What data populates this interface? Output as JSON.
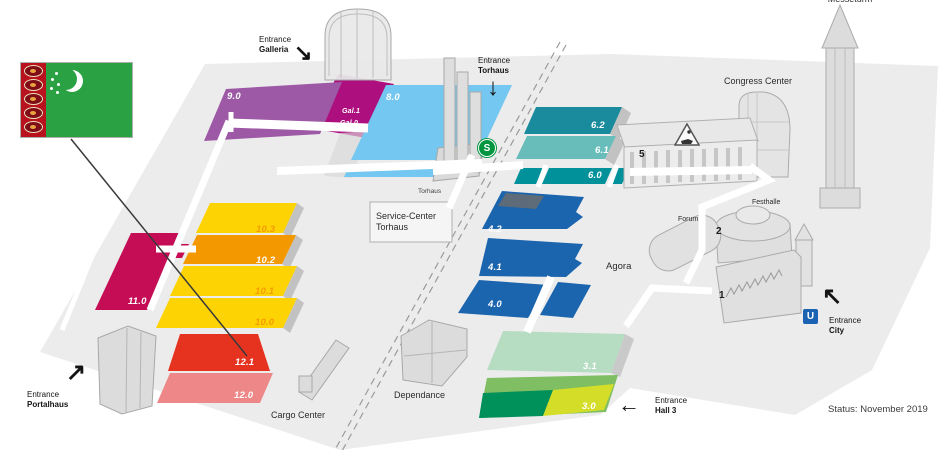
{
  "map": {
    "status": "Status: November 2019",
    "flag": {
      "country": "Turkmenistan",
      "field_color": "#2aa143",
      "stripe_color": "#b9121f"
    },
    "badges": {
      "sbahn": {
        "label": "S",
        "color": "#00963f"
      },
      "ubahn": {
        "label": "U",
        "color": "#1b63b2"
      }
    },
    "entrances": {
      "galleria": {
        "line1": "Entrance",
        "line2": "Galleria",
        "arrow": "↘"
      },
      "torhaus": {
        "line1": "Entrance",
        "line2": "Torhaus",
        "arrow": "↓"
      },
      "hall3": {
        "line1": "Entrance",
        "line2": "Hall 3",
        "arrow": "←"
      },
      "city": {
        "line1": "Entrance",
        "line2": "City",
        "arrow": "↖"
      },
      "portalhaus": {
        "line1": "Entrance",
        "line2": "Portalhaus",
        "arrow": "↗"
      }
    },
    "buildings": {
      "messeturm": "Messeturm",
      "congress_center": "Congress Center",
      "festhalle": "Festhalle",
      "forum": "Forum",
      "service_center_line1": "Service-Center",
      "service_center_line2": "Torhaus",
      "torhaus": "Torhaus",
      "agora": "Agora",
      "dependance": "Dependance",
      "cargo_center": "Cargo Center"
    },
    "halls": {
      "h9_0": {
        "label": "9.0",
        "color": "#9d59a5",
        "label_color": "#ffffff"
      },
      "gal": {
        "upper_label": "Gal.1",
        "lower_label": "Gal.0",
        "color": "#ae0f7f",
        "label_color": "#ffffff"
      },
      "h8_0": {
        "label": "8.0",
        "color": "#74c7f0",
        "label_color": "#ffffff"
      },
      "h6_2": {
        "label": "6.2",
        "color": "#1a8b9c",
        "label_color": "#ffffff"
      },
      "h6_1": {
        "label": "6.1",
        "color": "#68bdbb",
        "label_color": "#ffffff"
      },
      "h6_0": {
        "label": "6.0",
        "color": "#00919b",
        "label_color": "#ffffff"
      },
      "h5": {
        "label": "5",
        "color": "#ececec",
        "label_color": "#1a1a1a"
      },
      "h4_2": {
        "label": "4.2",
        "color": "#1b64ae",
        "roof_color": "#5e6b78",
        "label_color": "#ffffff"
      },
      "h4_1": {
        "label": "4.1",
        "color": "#1b64ae",
        "label_color": "#ffffff"
      },
      "h4_0": {
        "label": "4.0",
        "color": "#1b64ae",
        "label_color": "#ffffff"
      },
      "h10_3": {
        "label": "10.3",
        "color": "#fdd303",
        "label_color": "#f59c00"
      },
      "h10_2": {
        "label": "10.2",
        "color": "#f49800",
        "label_color": "#ffffff"
      },
      "h10_1": {
        "label": "10.1",
        "color": "#fdd303",
        "label_color": "#f59c00"
      },
      "h10_0": {
        "label": "10.0",
        "color": "#fdd303",
        "label_color": "#f59c00"
      },
      "h11_0": {
        "label": "11.0",
        "color": "#c40d55",
        "label_color": "#ffffff"
      },
      "h12_1": {
        "label": "12.1",
        "color": "#e63320",
        "label_color": "#ffffff"
      },
      "h12_0": {
        "label": "12.0",
        "color": "#ee8888",
        "label_color": "#ffffff"
      },
      "h3_1": {
        "label": "3.1",
        "color": "#b6dcc1",
        "label_color": "#ffffff"
      },
      "h3_0": {
        "label": "3.0",
        "color": "#7fbe62",
        "dark_color": "#00905a",
        "light_color": "#d4dd28",
        "label_color": "#ffffff"
      },
      "h2": {
        "label": "2",
        "label_color": "#1a1a1a"
      },
      "h1": {
        "label": "1",
        "label_color": "#1a1a1a"
      }
    }
  }
}
